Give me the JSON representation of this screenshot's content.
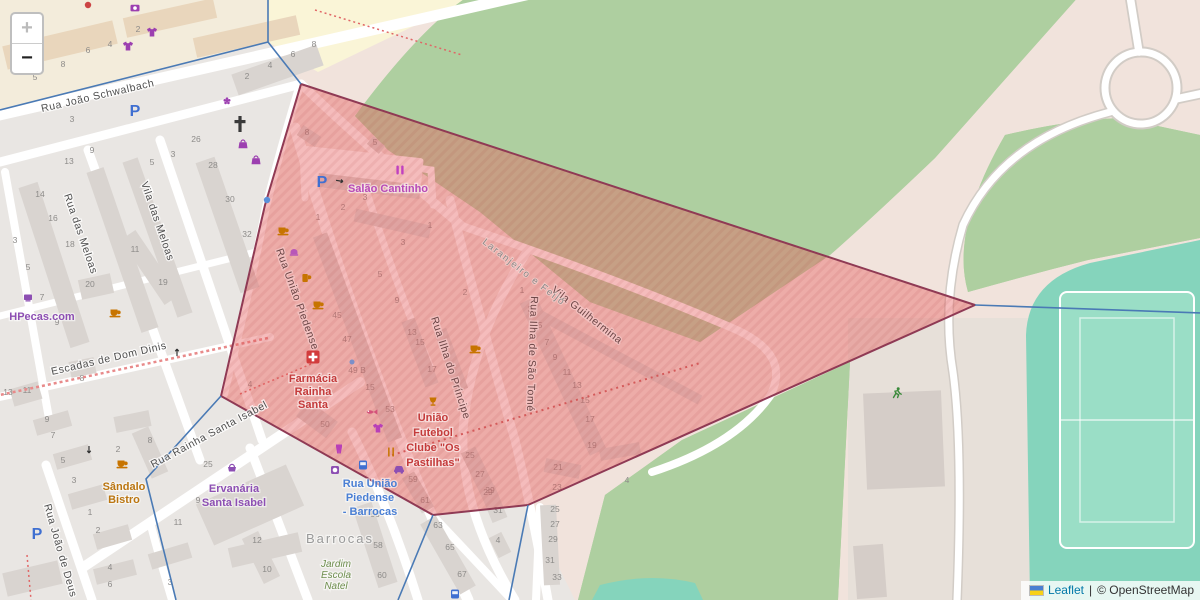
{
  "controls": {
    "zoom_in": "+",
    "zoom_out": "−"
  },
  "attribution": {
    "leaflet_link": "Leaflet",
    "separator": "|",
    "osm_credit": "© OpenStreetMap"
  },
  "colors": {
    "polygon_fill": "#e86060",
    "polygon_stroke": "#8f3a55",
    "boundary_blue": "#4a7ab5",
    "forest": "#aecfa0",
    "pitch": "#85d4bc",
    "residential": "#f1e3dc",
    "urban": "#e9e6e3"
  },
  "streets": {
    "schwalbach": "Rua João Schwalbach",
    "rua_das_meloas": "Rua das Meloas",
    "vila_das_meloas": "Vila das Meloas",
    "escadas": "Escadas de Dom Dinis",
    "rainha_santa": "Rua Rainha Santa Isabel",
    "joao_de_deus": "Rua João de Deus",
    "uniao_piedense": "Rua União Piedense",
    "ilha_principe": "Rua Ilha do Príncipe",
    "ilha_sao_tome": "Rua Ilha de São Tomé",
    "vila_guilhermina": "Vila Guilhermina",
    "boundary_label": "Laranjeiro e Feijó"
  },
  "places": {
    "salao_cantinho": "Salão Cantinho",
    "hpecas": "HPecas.com",
    "farmacia": [
      "Farmácia",
      "Rainha",
      "Santa"
    ],
    "clube": [
      "União",
      "Futebol",
      "Clube \"Os",
      "Pastilhas\""
    ],
    "sandalo": [
      "Sândalo",
      "Bistro"
    ],
    "ervanaria": [
      "Ervanária",
      "Santa Isabel"
    ],
    "bus_stop": [
      "Rua União",
      "Piedense",
      "- Barrocas"
    ],
    "barrocas": "Barrocas",
    "jardim": [
      "Jardim",
      "Escola",
      "Natel"
    ],
    "parking": "P"
  },
  "house_numbers": [
    {
      "x": 35,
      "y": 80,
      "v": "5"
    },
    {
      "x": 63,
      "y": 67,
      "v": "8"
    },
    {
      "x": 88,
      "y": 53,
      "v": "6"
    },
    {
      "x": 110,
      "y": 47,
      "v": "4"
    },
    {
      "x": 138,
      "y": 32,
      "v": "2"
    },
    {
      "x": 72,
      "y": 122,
      "v": "3"
    },
    {
      "x": 196,
      "y": 142,
      "v": "26"
    },
    {
      "x": 247,
      "y": 79,
      "v": "2"
    },
    {
      "x": 270,
      "y": 68,
      "v": "4"
    },
    {
      "x": 293,
      "y": 57,
      "v": "6"
    },
    {
      "x": 314,
      "y": 47,
      "v": "8"
    },
    {
      "x": 92,
      "y": 153,
      "v": "9"
    },
    {
      "x": 69,
      "y": 164,
      "v": "13"
    },
    {
      "x": 152,
      "y": 165,
      "v": "5"
    },
    {
      "x": 173,
      "y": 157,
      "v": "3"
    },
    {
      "x": 40,
      "y": 197,
      "v": "14"
    },
    {
      "x": 53,
      "y": 221,
      "v": "16"
    },
    {
      "x": 70,
      "y": 247,
      "v": "18"
    },
    {
      "x": 15,
      "y": 243,
      "v": "3"
    },
    {
      "x": 28,
      "y": 270,
      "v": "5"
    },
    {
      "x": 90,
      "y": 287,
      "v": "20"
    },
    {
      "x": 135,
      "y": 252,
      "v": "11"
    },
    {
      "x": 163,
      "y": 285,
      "v": "19"
    },
    {
      "x": 42,
      "y": 300,
      "v": "7"
    },
    {
      "x": 57,
      "y": 325,
      "v": "9"
    },
    {
      "x": 213,
      "y": 168,
      "v": "28"
    },
    {
      "x": 230,
      "y": 202,
      "v": "30"
    },
    {
      "x": 247,
      "y": 237,
      "v": "32"
    },
    {
      "x": 82,
      "y": 381,
      "v": "8"
    },
    {
      "x": 8,
      "y": 395,
      "v": "13"
    },
    {
      "x": 27,
      "y": 393,
      "v": "11"
    },
    {
      "x": 47,
      "y": 422,
      "v": "9"
    },
    {
      "x": 53,
      "y": 438,
      "v": "7"
    },
    {
      "x": 63,
      "y": 463,
      "v": "5"
    },
    {
      "x": 74,
      "y": 483,
      "v": "3"
    },
    {
      "x": 90,
      "y": 515,
      "v": "1"
    },
    {
      "x": 98,
      "y": 533,
      "v": "2"
    },
    {
      "x": 118,
      "y": 452,
      "v": "2"
    },
    {
      "x": 150,
      "y": 443,
      "v": "8"
    },
    {
      "x": 198,
      "y": 503,
      "v": "9"
    },
    {
      "x": 178,
      "y": 525,
      "v": "11"
    },
    {
      "x": 257,
      "y": 543,
      "v": "12"
    },
    {
      "x": 267,
      "y": 572,
      "v": "10"
    },
    {
      "x": 110,
      "y": 570,
      "v": "4"
    },
    {
      "x": 110,
      "y": 587,
      "v": "6"
    },
    {
      "x": 170,
      "y": 585,
      "v": "3"
    },
    {
      "x": 208,
      "y": 467,
      "v": "25"
    },
    {
      "x": 307,
      "y": 135,
      "v": "8"
    },
    {
      "x": 375,
      "y": 145,
      "v": "5"
    },
    {
      "x": 343,
      "y": 210,
      "v": "2"
    },
    {
      "x": 365,
      "y": 200,
      "v": "3"
    },
    {
      "x": 318,
      "y": 220,
      "v": "1"
    },
    {
      "x": 430,
      "y": 228,
      "v": "1"
    },
    {
      "x": 403,
      "y": 245,
      "v": "3"
    },
    {
      "x": 380,
      "y": 277,
      "v": "5"
    },
    {
      "x": 397,
      "y": 303,
      "v": "9"
    },
    {
      "x": 337,
      "y": 318,
      "v": "45"
    },
    {
      "x": 347,
      "y": 342,
      "v": "47"
    },
    {
      "x": 357,
      "y": 373,
      "v": "49 B"
    },
    {
      "x": 370,
      "y": 390,
      "v": "15"
    },
    {
      "x": 390,
      "y": 412,
      "v": "53"
    },
    {
      "x": 325,
      "y": 427,
      "v": "50"
    },
    {
      "x": 420,
      "y": 345,
      "v": "15"
    },
    {
      "x": 432,
      "y": 372,
      "v": "17"
    },
    {
      "x": 412,
      "y": 335,
      "v": "13"
    },
    {
      "x": 250,
      "y": 387,
      "v": "4"
    },
    {
      "x": 465,
      "y": 295,
      "v": "2"
    },
    {
      "x": 522,
      "y": 293,
      "v": "1"
    },
    {
      "x": 530,
      "y": 312,
      "v": "3"
    },
    {
      "x": 540,
      "y": 328,
      "v": "5"
    },
    {
      "x": 547,
      "y": 345,
      "v": "7"
    },
    {
      "x": 555,
      "y": 360,
      "v": "9"
    },
    {
      "x": 567,
      "y": 375,
      "v": "11"
    },
    {
      "x": 577,
      "y": 388,
      "v": "13"
    },
    {
      "x": 585,
      "y": 403,
      "v": "15"
    },
    {
      "x": 590,
      "y": 422,
      "v": "17"
    },
    {
      "x": 592,
      "y": 448,
      "v": "19"
    },
    {
      "x": 558,
      "y": 470,
      "v": "21"
    },
    {
      "x": 557,
      "y": 490,
      "v": "23"
    },
    {
      "x": 470,
      "y": 458,
      "v": "25"
    },
    {
      "x": 480,
      "y": 477,
      "v": "27"
    },
    {
      "x": 490,
      "y": 493,
      "v": "29"
    },
    {
      "x": 413,
      "y": 482,
      "v": "59"
    },
    {
      "x": 425,
      "y": 503,
      "v": "61"
    },
    {
      "x": 438,
      "y": 528,
      "v": "63"
    },
    {
      "x": 450,
      "y": 550,
      "v": "65"
    },
    {
      "x": 462,
      "y": 577,
      "v": "67"
    },
    {
      "x": 375,
      "y": 517,
      "v": "56"
    },
    {
      "x": 378,
      "y": 548,
      "v": "58"
    },
    {
      "x": 382,
      "y": 578,
      "v": "60"
    },
    {
      "x": 488,
      "y": 495,
      "v": "29"
    },
    {
      "x": 498,
      "y": 513,
      "v": "31"
    },
    {
      "x": 498,
      "y": 543,
      "v": "4"
    },
    {
      "x": 555,
      "y": 512,
      "v": "25"
    },
    {
      "x": 555,
      "y": 527,
      "v": "27"
    },
    {
      "x": 553,
      "y": 542,
      "v": "29"
    },
    {
      "x": 550,
      "y": 563,
      "v": "31"
    },
    {
      "x": 557,
      "y": 580,
      "v": "33"
    },
    {
      "x": 627,
      "y": 483,
      "v": "4"
    }
  ]
}
